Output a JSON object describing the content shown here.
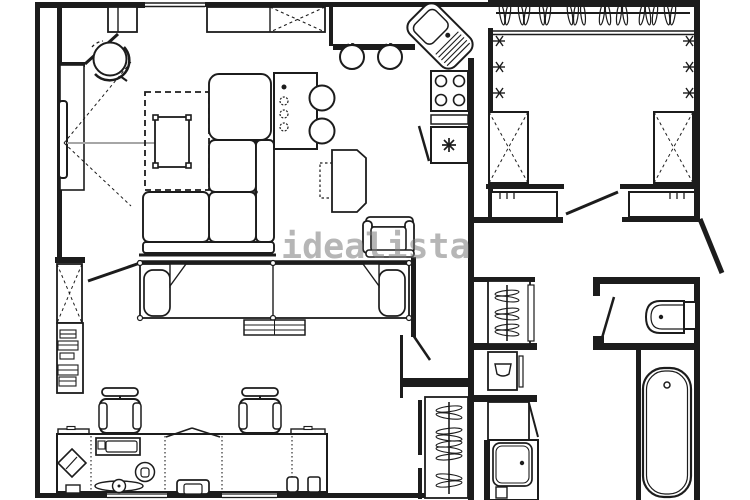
{
  "watermark": {
    "text": "idealista"
  },
  "colors": {
    "line": "#1c1c1c",
    "sightline": "#a6a6a6",
    "watermark": "rgba(122,122,122,0.55)",
    "background": "#ffffff"
  },
  "plan": {
    "type": "apartment-floor-plan",
    "fixtures": [
      "entry-door",
      "swivel-chair",
      "tv",
      "media-console",
      "coffee-table",
      "rug",
      "sectional-sofa",
      "bar-table",
      "bar-stools",
      "wall-cabinets",
      "kitchen-corner-sink",
      "stove-4-burner",
      "kitchen-appliance",
      "kitchen-peninsula",
      "walkin-closet-hanger-rail",
      "wall-hooks",
      "crossed-wardrobes",
      "dressers",
      "double-bed",
      "bed-bench",
      "armchair",
      "side-unit",
      "bookshelf",
      "crossed-cabinet",
      "office-desk",
      "office-chairs",
      "desk-lamp",
      "printer",
      "turntable",
      "desk-phone",
      "laptop",
      "speakers",
      "hall-wardrobe",
      "boiler-closet",
      "laundry-cabinet",
      "laundry-sink",
      "coat-closet",
      "toilet",
      "bathtub",
      "windows"
    ]
  }
}
